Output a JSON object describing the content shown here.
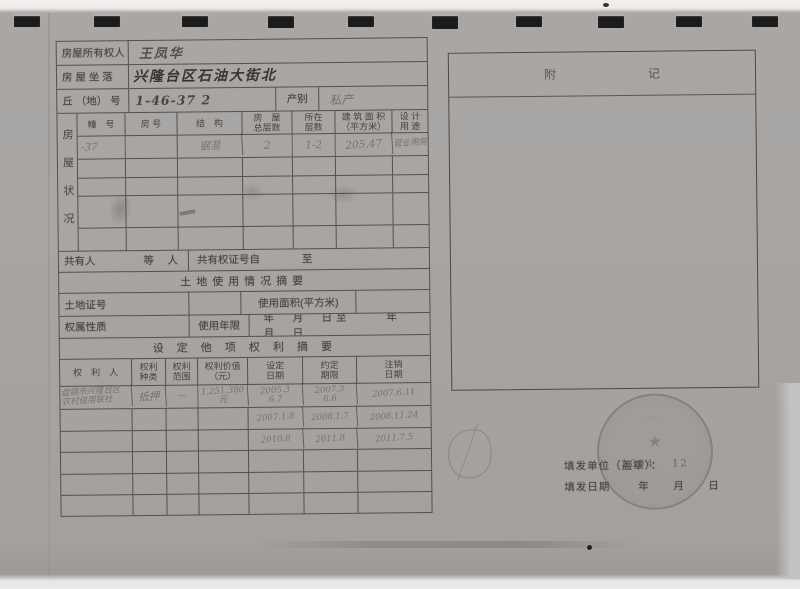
{
  "colors": {
    "scan_background": "#a8a5a3",
    "paper_edge": "#f0efed",
    "table_line": "#3a342f",
    "printed_ink": "#3f3b36",
    "pencil_ink": "#6b665f",
    "binding_mark": "#1d1c1c"
  },
  "header": {
    "owner_label": "房屋所有权人",
    "owner_value": "王凤华",
    "location_label": "房 屋  坐 落",
    "location_value": "兴隆台区石油大街北",
    "plot_label": "丘 （地） 号",
    "plot_value": "1-46-37 2",
    "category_label": "产别",
    "category_value": "私产"
  },
  "house_status": {
    "vertical_label": "房屋状况",
    "columns": [
      "幢　号",
      "房 号",
      "结　构",
      "房　屋\n总层数",
      "所在\n层数",
      "建 筑 面 积\n（平方米）",
      "设 计\n用 途"
    ],
    "row1": {
      "building_no": "-37",
      "room_no": "",
      "structure": "钢混",
      "total_floors": "2",
      "floor": "1-2",
      "area": "205.47",
      "use": "营业用房"
    }
  },
  "co_owner": {
    "label": "共有人",
    "suffix": "等　 人",
    "cert_label": "共有权证号自",
    "to_label": "至"
  },
  "land": {
    "section_title": "土地使用情况摘要",
    "cert_label": "土地证号",
    "area_label": "使用面积(平方米)",
    "nature_label": "权属性质",
    "term_label": "使用年限",
    "term_dates": "年　月　日至　　 年　月　日"
  },
  "other_rights": {
    "section_title": "设 定 他 项 权 利 摘 要",
    "columns": [
      "权　利　人",
      "权利\n种类",
      "权利\n范围",
      "权利价值\n（元）",
      "设定\n日期",
      "约定\n期限",
      "注销\n日期"
    ],
    "rows": [
      {
        "holder": "盘锦市兴隆台区\n农村信用联社",
        "kind": "抵押",
        "scope": "—",
        "value": "1,251,380元",
        "set_date": "2005.3\n6.7",
        "term": "2007.3\n6.6",
        "cancel_date": "2007.6.11"
      },
      {
        "set_date": "2007.1.8",
        "term": "2008.1.7",
        "cancel_date": "2008.11.24"
      },
      {
        "set_date": "2010.8",
        "term": "2011.8",
        "cancel_date": "2011.7.5"
      }
    ]
  },
  "appendix": {
    "title": "附　记"
  },
  "stamp": {
    "visible_text": "2004　 12"
  },
  "footer": {
    "issuer_label": "填发单位（盖章）：",
    "date_label": "填发日期",
    "date_units": "年　月　日"
  }
}
